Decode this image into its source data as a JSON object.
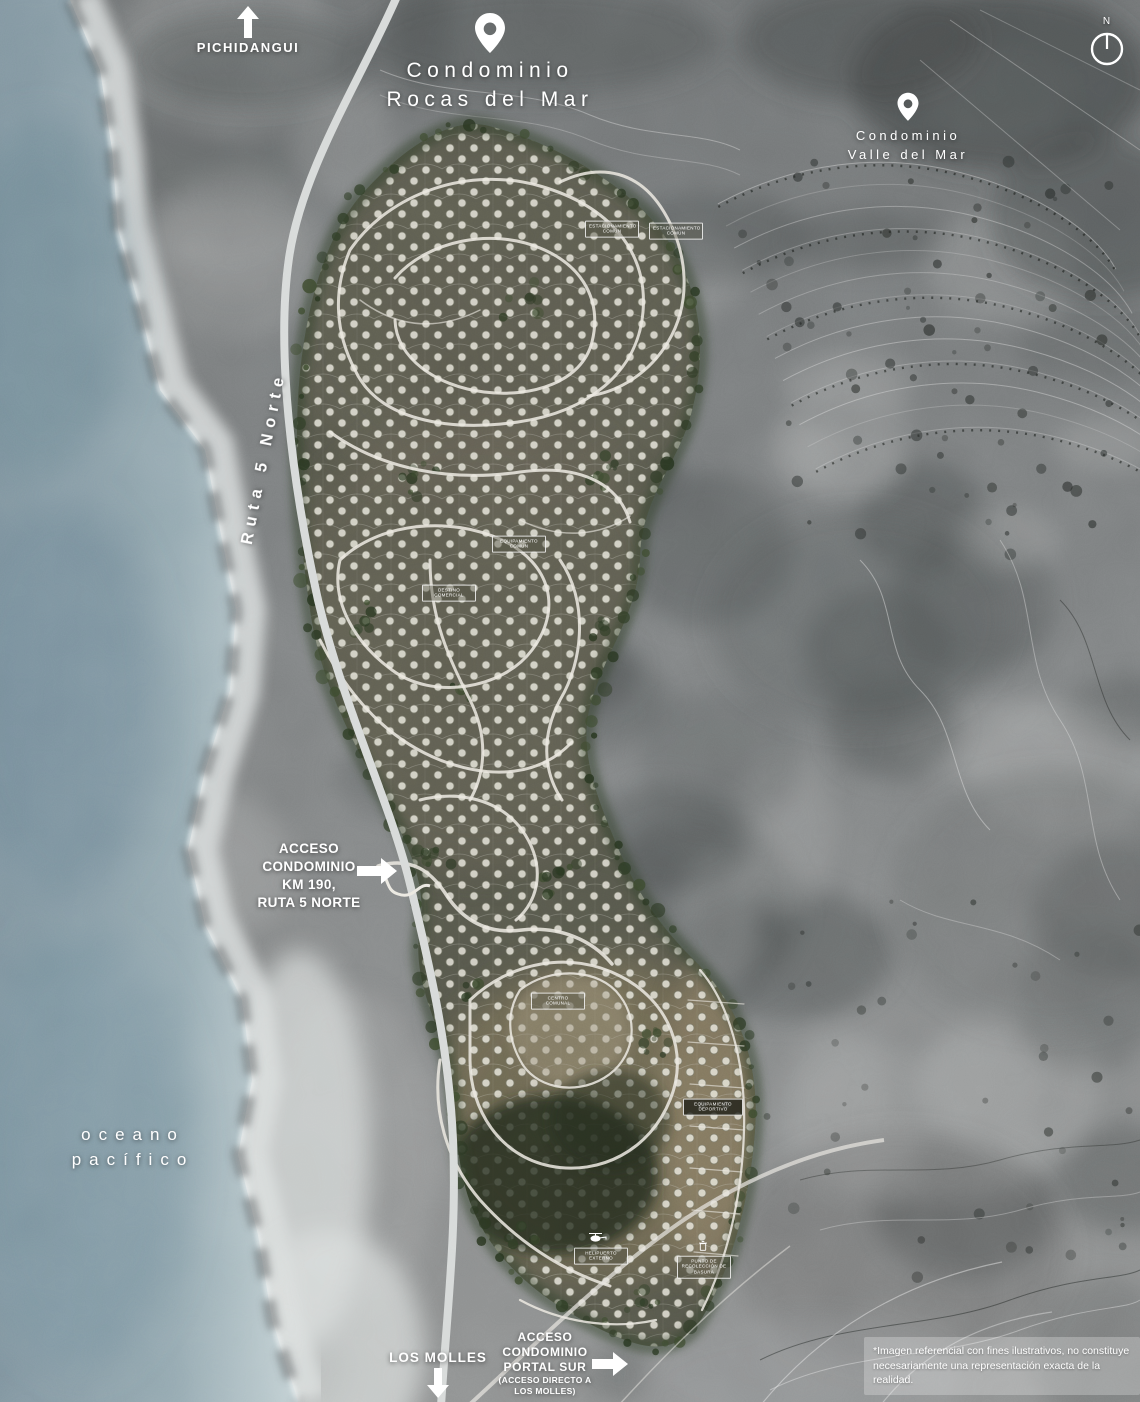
{
  "labels": {
    "pichidangui": "PICHIDANGUI",
    "rocas": {
      "line1": "Condominio",
      "line2": "Rocas del Mar"
    },
    "valle": {
      "line1": "Condominio",
      "line2": "Valle del Mar"
    },
    "compass": "N",
    "ruta": "Ruta 5 Norte",
    "ocean": {
      "line1": "oceano",
      "line2": "pacífico"
    },
    "access_north": {
      "line1": "ACCESO",
      "line2": "CONDOMINIO",
      "line3": "KM 190,",
      "line4": "RUTA 5 NORTE"
    },
    "los_molles": "LOS MOLLES",
    "access_south": {
      "line1": "ACCESO",
      "line2": "CONDOMINIO",
      "line3": "PORTAL SUR",
      "line4": "(ACCESO DIRECTO A",
      "line5": "LOS MOLLES)"
    },
    "disclaimer": "*Imagen referencial con fines ilustrativos, no constituye necesariamente una representación exacta de la realidad."
  },
  "poi": {
    "parking1": "ESTACIONAMIENTO COMÚN",
    "parking2": "ESTACIONAMIENTO COMÚN",
    "equipamiento": "EQUIPAMIENTO COMÚN",
    "comercial": "DESTINO COMERCIAL",
    "comunal": "CENTRO COMUNAL",
    "deportivo": "EQUIPAMIENTO DEPORTIVO",
    "helipuerto": "HELIPUERTO EXTERNO",
    "basura": "PUNTO DE RECOLECCIÓN DE BASURA"
  },
  "colors": {
    "ocean": "#8aa0aa",
    "sand": "#d8dcdc",
    "land": "#7e8182",
    "development": "#55564a",
    "roads": "#ece9e1",
    "highway": "#d6d9d8",
    "trees": "#2f3a25",
    "label_text": "#ffffff"
  }
}
